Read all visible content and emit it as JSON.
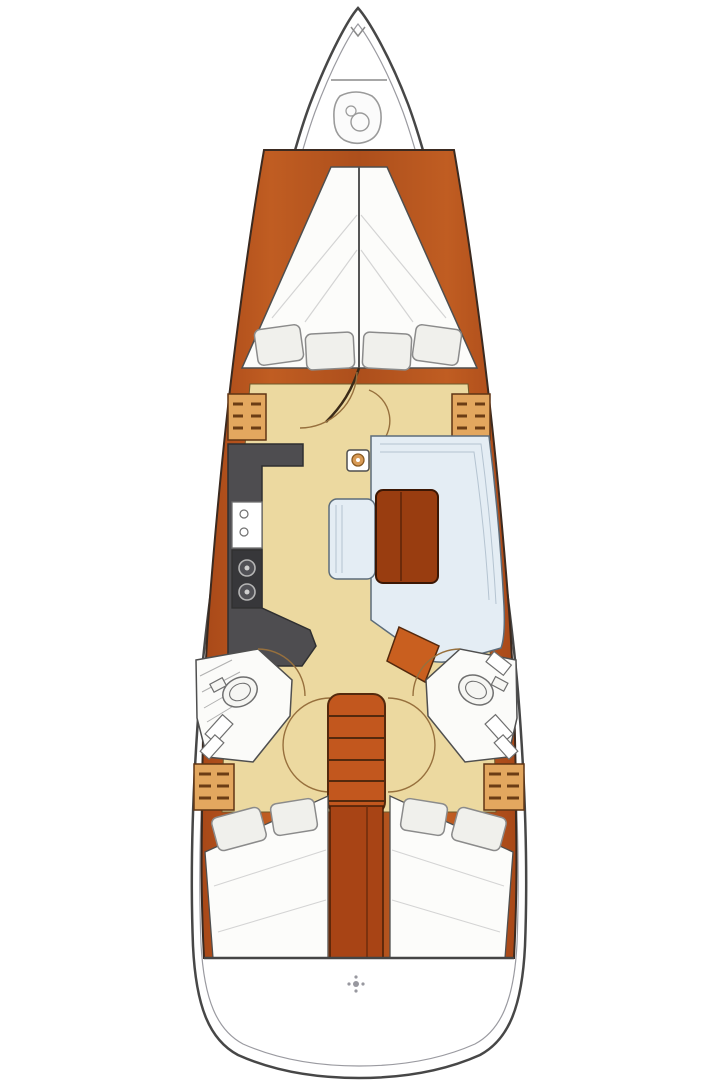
{
  "diagram": {
    "kind": "sailboat-interior-floorplan",
    "view": "top-down",
    "width_px": 719,
    "height_px": 1080
  },
  "areas": [
    {
      "name": "bow-anchor-locker"
    },
    {
      "name": "windlass"
    },
    {
      "name": "forward-cabin-v-berth"
    },
    {
      "name": "forward-cabin-lockers"
    },
    {
      "name": "mast-step"
    },
    {
      "name": "galley"
    },
    {
      "name": "saloon-settee"
    },
    {
      "name": "saloon-table"
    },
    {
      "name": "saloon-bench"
    },
    {
      "name": "left-head"
    },
    {
      "name": "right-head"
    },
    {
      "name": "companionway-steps"
    },
    {
      "name": "engine-compartment"
    },
    {
      "name": "left-aft-cabin"
    },
    {
      "name": "right-aft-cabin"
    },
    {
      "name": "transom"
    }
  ],
  "colors": {
    "deck": "#ffffff",
    "hull_outline": "#474747",
    "toe_rail": "#9a9aa0",
    "pulpit": "#8a8a8a",
    "wood": "#b5521d",
    "wood_bright": "#c95f1f",
    "wood_edge": "#3b2a20",
    "sole": "#ecd9a0",
    "sole_edge": "#6e5a2b",
    "locker": "#e3a75f",
    "locker_edge": "#5f3414",
    "locker_dash": "#6b3c15",
    "galley_counter": "#4e4d50",
    "galley_edge": "#2f2f30",
    "stove": "#37373a",
    "burner_ring": "#b5b5b5",
    "burner_fill": "#515156",
    "sink": "#ffffff",
    "settee": "#e4edf4",
    "settee_edge": "#5c6c7a",
    "settee_stripe": "#b5c4d1",
    "table": "#993d10",
    "table_edge": "#3c1704",
    "table_seam": "#5c2408",
    "steps": "#c2571e",
    "steps_edge": "#54290d",
    "engine": "#a84415",
    "engine_edge": "#481e06",
    "engine_seam": "#6e2c0c",
    "berth": "#fcfcfa",
    "berth_edge": "#4f4f4f",
    "berth_seam": "#555555",
    "crease": "#d4d4d4",
    "pillow": "#f0f0ec",
    "pillow_edge": "#8b8b8b",
    "head_room": "#fbfbf9",
    "head_edge": "#4f4f4f",
    "fixture_fill": "#f6f6f3",
    "fixture_line": "#6f6f6f",
    "hatch_line": "#b0b0b0",
    "door_arc": "#97703d",
    "door_leaf": "#3a2a18",
    "mast_plate": "#ffffff",
    "mast_ring": "#d89a55",
    "mast_ring_edge": "#8a5a20",
    "stern_line": "#454545",
    "transom_mark": "#98989f",
    "windlass_line": "#9a9a9a",
    "windlass_fill": "#fbfbfb"
  }
}
